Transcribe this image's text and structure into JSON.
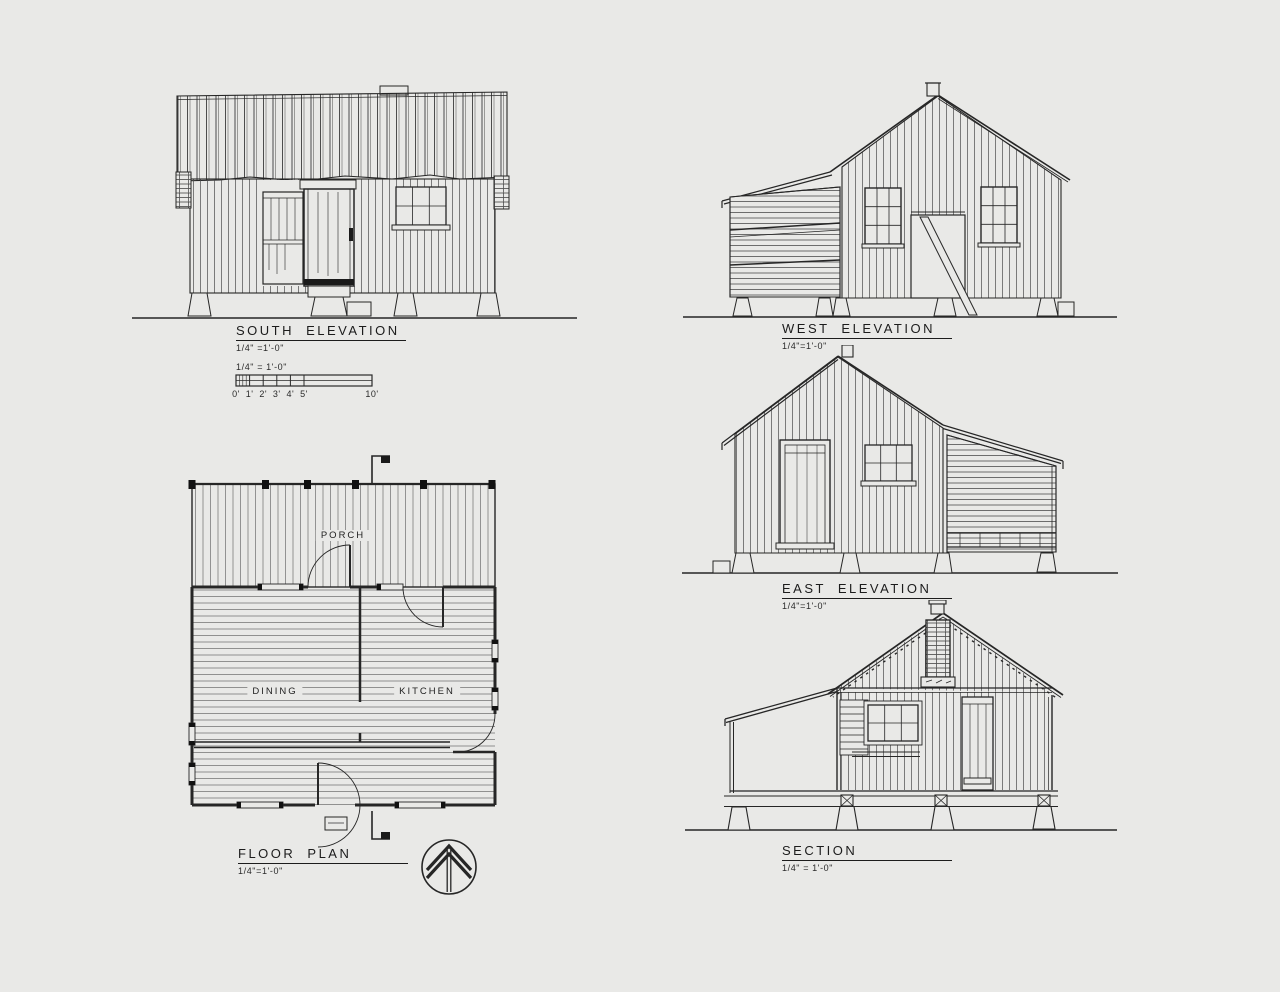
{
  "sheet": {
    "paper_color": "#e9e9e7",
    "ink_color": "#222222"
  },
  "drawings": {
    "south_elevation": {
      "title": "SOUTH ELEVATION",
      "scale_note": "1/4\" =1'-0\""
    },
    "west_elevation": {
      "title": "WEST ELEVATION",
      "scale_note": "1/4\"=1'-0\""
    },
    "east_elevation": {
      "title": "EAST ELEVATION",
      "scale_note": "1/4\"=1'-0\""
    },
    "floor_plan": {
      "title": "FLOOR PLAN",
      "scale_note": "1/4\"=1'-0\"",
      "rooms": {
        "porch": "PORCH",
        "dining": "DINING",
        "kitchen": "KITCHEN"
      }
    },
    "section": {
      "title": "SECTION",
      "scale_note": "1/4\" = 1'-0\""
    }
  },
  "scale_bar": {
    "caption": "1/4\" = 1'-0\"",
    "tick_labels": [
      "0'",
      "1'",
      "2'",
      "3'",
      "4'",
      "5'",
      "10'"
    ]
  },
  "icons": {
    "north_arrow": "north-arrow-icon",
    "section_cut_marker": "section-cut-flag-icon"
  }
}
